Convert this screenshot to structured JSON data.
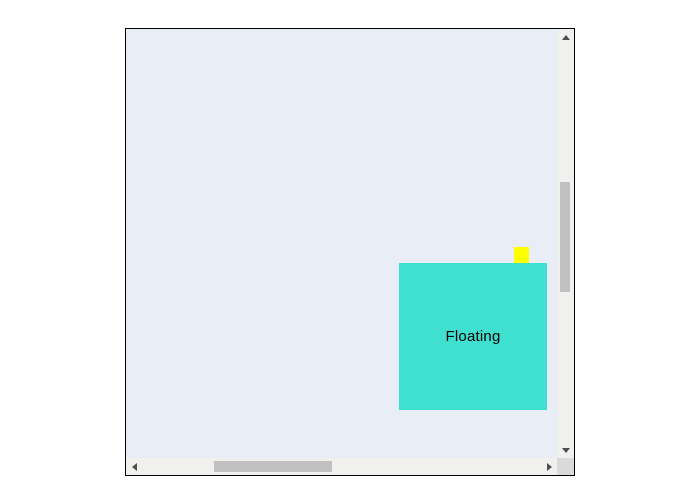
{
  "window": {
    "width": 700,
    "height": 501,
    "background_color": "#ffffff"
  },
  "scroll_container": {
    "background_color": "#e9edf6",
    "border_color": "#000000",
    "vertical_scrollbar": {
      "track_color": "#f0f0ee",
      "thumb_color": "#c0c0c0",
      "arrow_color": "#4d4d4d",
      "up_icon": "triangle-up",
      "down_icon": "triangle-down"
    },
    "horizontal_scrollbar": {
      "track_color": "#f0f0ee",
      "thumb_color": "#c0c0c0",
      "arrow_color": "#4d4d4d",
      "left_icon": "triangle-left",
      "right_icon": "triangle-right"
    },
    "corner_color": "#dadada"
  },
  "floating_panel": {
    "label": "Floating",
    "background_color": "#40e0d0",
    "text_color": "#000000"
  },
  "handle": {
    "color": "#ffff00"
  }
}
